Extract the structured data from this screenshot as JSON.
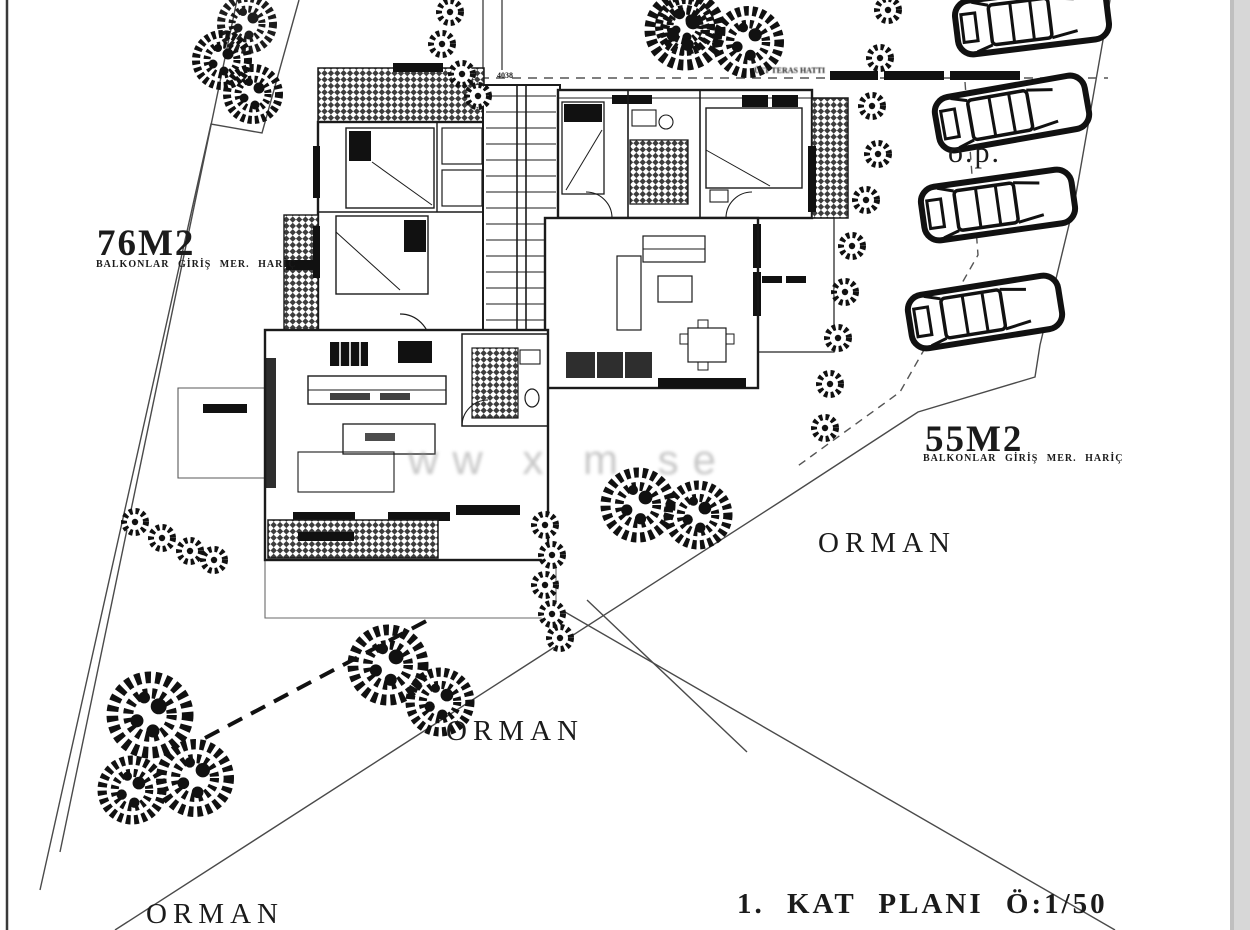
{
  "colors": {
    "ink": "#1b1b1b",
    "boundary": "#4a4a4a",
    "paper": "#ffffff",
    "scan_edge": "#d7d7d7",
    "watermark": "#8f8f8f"
  },
  "labels": {
    "area_left_title": "76M2",
    "area_left_note": "BALKONLAR GİRİŞ MER. HARİÇ",
    "area_right_title": "55M2",
    "area_right_note": "BALKONLAR GİRİŞ MER. HARİÇ",
    "forest_right": "ORMAN",
    "forest_center": "ORMAN",
    "forest_bottom": "ORMAN",
    "open_parking": "o.p.",
    "terrace_note": "ÜST TERAS HATTI",
    "dimension_top": "4038",
    "plan_title": "1. KAT PLANI Ö:1/50",
    "watermark": "ww x m se"
  }
}
